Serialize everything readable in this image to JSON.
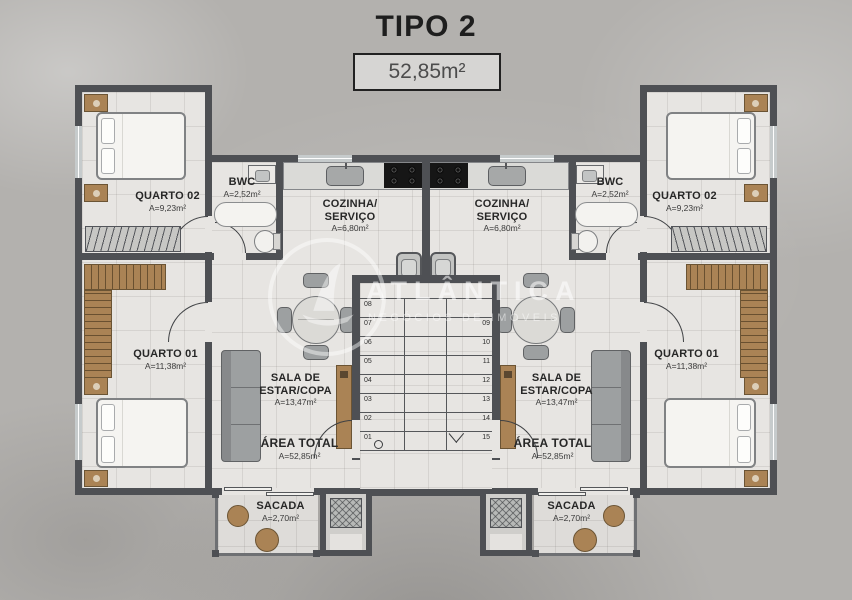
{
  "title": "TIPO 2",
  "area_badge": "52,85m²",
  "watermark": {
    "brand": "ATLÂNTICA",
    "subtitle": "NEGÓCIOS DE IMÓVEIS"
  },
  "rooms": {
    "quarto02": {
      "name": "QUARTO 02",
      "area": "A=9,23m²"
    },
    "bwc": {
      "name": "BWC",
      "area": "A=2,52m²"
    },
    "cozinha": {
      "name1": "COZINHA/",
      "name2": "SERVIÇO",
      "area": "A=6,80m²"
    },
    "quarto01": {
      "name": "QUARTO 01",
      "area": "A=11,38m²"
    },
    "sala": {
      "name1": "SALA DE",
      "name2": "ESTAR/COPA",
      "area": "A=13,47m²"
    },
    "area_total": {
      "name": "ÁREA TOTAL",
      "area": "A=52,85m²"
    },
    "sacada": {
      "name": "SACADA",
      "area": "A=2,70m²"
    }
  },
  "stairs": {
    "left": [
      "08",
      "07",
      "06",
      "05",
      "04",
      "03",
      "02",
      "01"
    ],
    "right": [
      "09",
      "10",
      "11",
      "12",
      "13",
      "14",
      "15"
    ]
  },
  "colors": {
    "wall": "#4e5054",
    "wood": "#aa8355",
    "floor": "#e7e5e2",
    "ground": "#b3b1ae"
  }
}
